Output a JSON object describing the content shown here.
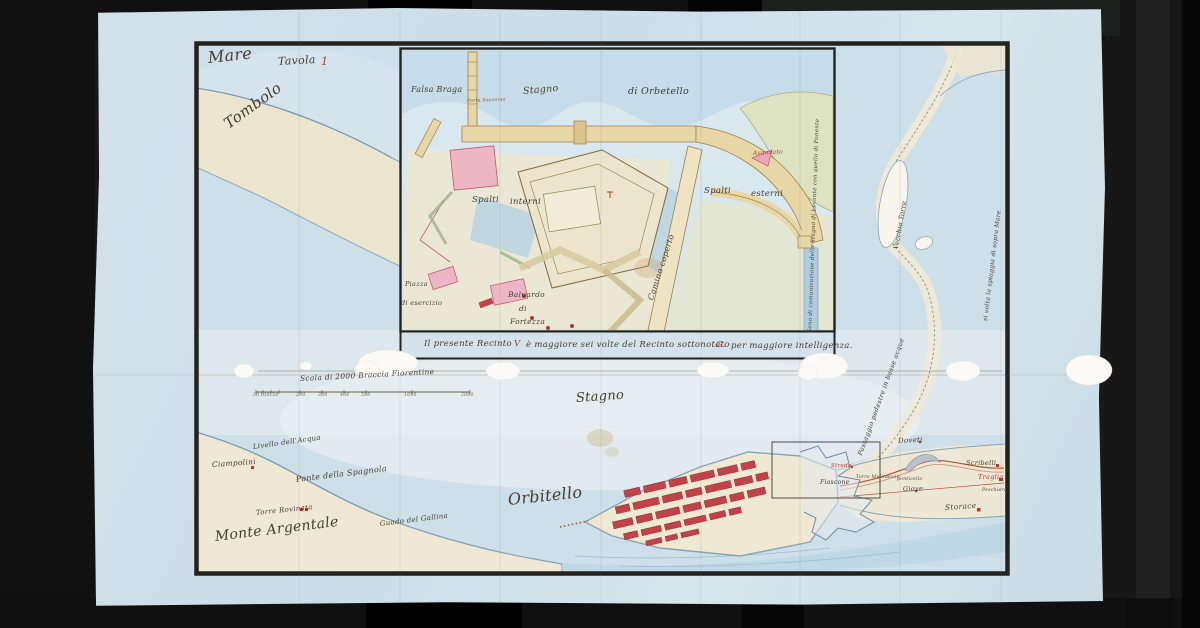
{
  "map": {
    "colors": {
      "paper": "#cfe0e9",
      "ink": "#453e30",
      "red_ink": "#b03a30",
      "town_red": "#c2424a",
      "water": "#bcd5e2",
      "land": "#ece5cf",
      "frame": "#24221c",
      "works_tan": "#e7d6a6",
      "pink_walls": "#ecb6c4"
    },
    "caption": "Il presente Recinto V è maggiore sei volte del Recinto sottonotato G. per maggiore intelligenza.",
    "scale": {
      "label": "Scala di 2000 Braccia Fiorentine",
      "ticks": [
        "50",
        "100",
        "150",
        "200",
        "300",
        "400",
        "500",
        "1000",
        "2000"
      ]
    },
    "inset_side_note": "Seno di comunicazione dello Stagno di Levante con quello di Ponente",
    "labels": [
      {
        "id": "mare",
        "text": "Mare",
        "x": 208,
        "y": 50,
        "fs": 16,
        "rot": -6
      },
      {
        "id": "tavola",
        "text": "Tavola",
        "x": 278,
        "y": 56,
        "fs": 11,
        "rot": -3
      },
      {
        "id": "tavola-number",
        "text": "1",
        "x": 321,
        "y": 56,
        "fs": 11,
        "rot": 0,
        "c": "#b03a30"
      },
      {
        "id": "tombolo",
        "text": "Tombolo",
        "x": 226,
        "y": 118,
        "fs": 15,
        "rot": -36
      },
      {
        "id": "falsa-braga",
        "text": "Falsa Braga",
        "x": 411,
        "y": 86,
        "fs": 8
      },
      {
        "id": "stagno-inset",
        "text": "Stagno",
        "x": 523,
        "y": 87,
        "fs": 9.5,
        "rot": -5
      },
      {
        "id": "di-orbetello",
        "text": "di Orbetello",
        "x": 628,
        "y": 87,
        "fs": 9.5
      },
      {
        "id": "porta-soccorso",
        "text": "Porta Soccorso",
        "x": 467,
        "y": 100,
        "fs": 4.5,
        "rot": -2,
        "c": "#8a4a2a"
      },
      {
        "id": "avanzato",
        "text": "Avanzato",
        "x": 753,
        "y": 151,
        "fs": 6,
        "rot": -3,
        "c": "#b03a30"
      },
      {
        "id": "spalti-interni-1",
        "text": "Spalti",
        "x": 472,
        "y": 196,
        "fs": 8.5
      },
      {
        "id": "spalti-interni-2",
        "text": "interni",
        "x": 510,
        "y": 198,
        "fs": 8.5
      },
      {
        "id": "spalti-esterni-1",
        "text": "Spalti",
        "x": 704,
        "y": 187,
        "fs": 8.5
      },
      {
        "id": "spalti-esterni-2",
        "text": "esterni",
        "x": 751,
        "y": 190,
        "fs": 8.5
      },
      {
        "id": "camino-coperto",
        "text": "Camino coperto",
        "x": 651,
        "y": 296,
        "fs": 8,
        "rot": -72
      },
      {
        "id": "piazza-1",
        "text": "Piazza",
        "x": 405,
        "y": 281,
        "fs": 6.5
      },
      {
        "id": "piazza-2",
        "text": "di esercizio",
        "x": 401,
        "y": 300,
        "fs": 6.5
      },
      {
        "id": "baluardo-1",
        "text": "Baluardo",
        "x": 508,
        "y": 291,
        "fs": 7.5
      },
      {
        "id": "baluardo-2",
        "text": "di",
        "x": 519,
        "y": 305,
        "fs": 7.5
      },
      {
        "id": "baluardo-3",
        "text": "Fortezza",
        "x": 510,
        "y": 318,
        "fs": 7.5
      },
      {
        "id": "seno-note",
        "text": "Seno di comunicazione dello Stagno di Levante con quello di Ponente",
        "x": 811,
        "y": 330,
        "fs": 5.5,
        "rot": -88
      },
      {
        "id": "caption-1",
        "text": "Il presente Recinto",
        "x": 424,
        "y": 340,
        "fs": 8.5
      },
      {
        "id": "caption-v",
        "text": "V",
        "x": 514,
        "y": 340,
        "fs": 8.5,
        "c": "#b03a30"
      },
      {
        "id": "caption-2",
        "text": "è maggiore sei volte del Recinto sottonotato",
        "x": 526,
        "y": 341,
        "fs": 8.5
      },
      {
        "id": "caption-g",
        "text": "G.",
        "x": 716,
        "y": 341,
        "fs": 8.5,
        "c": "#b03a30"
      },
      {
        "id": "caption-3",
        "text": "per maggiore intelligenza.",
        "x": 731,
        "y": 342,
        "fs": 8.5
      },
      {
        "id": "scale-label",
        "text": "Scala di 2000 Braccia Fiorentine",
        "x": 300,
        "y": 375,
        "fs": 7.5,
        "rot": -3
      },
      {
        "id": "tick-50",
        "text": "50",
        "x": 253,
        "y": 394,
        "fs": 4.5,
        "c": "#6f6046"
      },
      {
        "id": "tick-100",
        "text": "100",
        "x": 260,
        "y": 394,
        "fs": 4.5,
        "c": "#6f6046"
      },
      {
        "id": "tick-150",
        "text": "150",
        "x": 269,
        "y": 394,
        "fs": 4.5,
        "c": "#6f6046"
      },
      {
        "id": "tick-200",
        "text": "200",
        "x": 296,
        "y": 394,
        "fs": 4.5,
        "c": "#6f6046"
      },
      {
        "id": "tick-300",
        "text": "300",
        "x": 318,
        "y": 394,
        "fs": 4.5,
        "c": "#6f6046"
      },
      {
        "id": "tick-400",
        "text": "400",
        "x": 340,
        "y": 394,
        "fs": 4.5,
        "c": "#6f6046"
      },
      {
        "id": "tick-500",
        "text": "500",
        "x": 361,
        "y": 394,
        "fs": 4.5,
        "c": "#6f6046"
      },
      {
        "id": "tick-1000",
        "text": "1000",
        "x": 404,
        "y": 394,
        "fs": 4.5,
        "c": "#6f6046"
      },
      {
        "id": "tick-2000",
        "text": "2000",
        "x": 461,
        "y": 394,
        "fs": 4.5,
        "c": "#6f6046"
      },
      {
        "id": "stagno-main",
        "text": "Stagno",
        "x": 576,
        "y": 392,
        "fs": 13,
        "rot": -4
      },
      {
        "id": "orbitello",
        "text": "Orbitello",
        "x": 508,
        "y": 492,
        "fs": 16,
        "rot": -6
      },
      {
        "id": "livello-acqua",
        "text": "Livello dell'Acqua",
        "x": 253,
        "y": 444,
        "fs": 7,
        "rot": -8
      },
      {
        "id": "ciampolini",
        "text": "Ciampolini",
        "x": 212,
        "y": 461,
        "fs": 7.5,
        "rot": -4
      },
      {
        "id": "ponte-spagnola",
        "text": "Ponte della Spagnola",
        "x": 296,
        "y": 476,
        "fs": 8,
        "rot": -7
      },
      {
        "id": "torre-rovinata",
        "text": "Torre Rovinata",
        "x": 256,
        "y": 510,
        "fs": 7,
        "rot": -6
      },
      {
        "id": "monte-argentale",
        "text": "Monte Argentale",
        "x": 215,
        "y": 530,
        "fs": 14,
        "rot": -7
      },
      {
        "id": "guado-gallina",
        "text": "Guado del Gallina",
        "x": 380,
        "y": 521,
        "fs": 7,
        "rot": -7
      },
      {
        "id": "passaggio-pedestre",
        "text": "Passaggio pedestre in basse acque",
        "x": 860,
        "y": 452,
        "fs": 6.5,
        "rot": -70
      },
      {
        "id": "vecchia-torre",
        "text": "Vecchia Torre",
        "x": 896,
        "y": 246,
        "fs": 6.5,
        "rot": -80
      },
      {
        "id": "right-edge-note",
        "text": "si volta la spiaggia di sopra Mare",
        "x": 986,
        "y": 318,
        "fs": 6,
        "rot": -83
      },
      {
        "id": "doveti",
        "text": "Doveti",
        "x": 898,
        "y": 438,
        "fs": 7,
        "rot": -3
      },
      {
        "id": "strada",
        "text": "Strada",
        "x": 831,
        "y": 464,
        "fs": 5.5,
        "c": "#b03a30"
      },
      {
        "id": "fiascone",
        "text": "Fiascone",
        "x": 820,
        "y": 480,
        "fs": 6
      },
      {
        "id": "torre-mulinaccio",
        "text": "Torre Mulinaccio",
        "x": 856,
        "y": 476,
        "fs": 4.5
      },
      {
        "id": "ponticello",
        "text": "ponticello",
        "x": 897,
        "y": 478,
        "fs": 4.5
      },
      {
        "id": "giove",
        "text": "Giove",
        "x": 903,
        "y": 486,
        "fs": 6.5,
        "rot": -2
      },
      {
        "id": "scribelli",
        "text": "Scribelli",
        "x": 966,
        "y": 460,
        "fs": 6.5
      },
      {
        "id": "traglia",
        "text": "Traglia",
        "x": 978,
        "y": 474,
        "fs": 6.5,
        "c": "#b03a30"
      },
      {
        "id": "peschiera",
        "text": "Peschiera",
        "x": 982,
        "y": 489,
        "fs": 4.5
      },
      {
        "id": "storace",
        "text": "Storace",
        "x": 945,
        "y": 504,
        "fs": 7.5,
        "rot": -4
      }
    ]
  }
}
